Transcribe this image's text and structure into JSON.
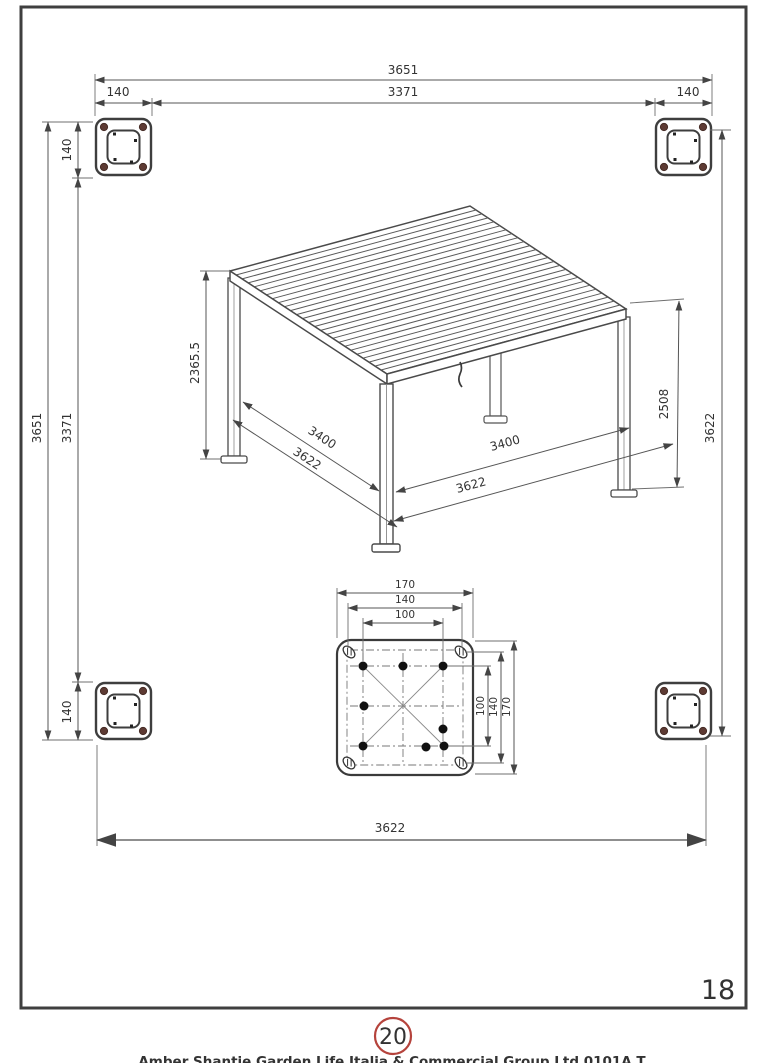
{
  "page": {
    "number": "18",
    "step_badge": "20",
    "caption_clipped": "Amber Shantie Garden Life Italia & Commercial Group Ltd 0101A T"
  },
  "plan_view": {
    "dim_top_overall": "3651",
    "dim_top_inner": "3371",
    "dim_top_post_left": "140",
    "dim_top_post_right": "140",
    "dim_left_overall": "3651",
    "dim_left_inner": "3371",
    "dim_left_post_top": "140",
    "dim_left_post_bottom": "140",
    "dim_right_roof": "3622",
    "dim_bottom_roof": "3622"
  },
  "isometric_view": {
    "dim_height_left": "2365.5",
    "dim_height_right": "2508",
    "dim_left_inner": "3400",
    "dim_left_roof": "3622",
    "dim_right_inner": "3400",
    "dim_right_roof": "3622"
  },
  "base_plate_detail": {
    "dim_top_outer": "170",
    "dim_top_mid": "140",
    "dim_top_inner": "100",
    "dim_right_outer": "170",
    "dim_right_mid": "140",
    "dim_right_inner": "100"
  },
  "colors": {
    "badge_red": "#b5433c",
    "bolt_maroon": "#5d3a33",
    "line_dark": "#3f3f3f"
  },
  "louvers": {
    "count": 25
  }
}
